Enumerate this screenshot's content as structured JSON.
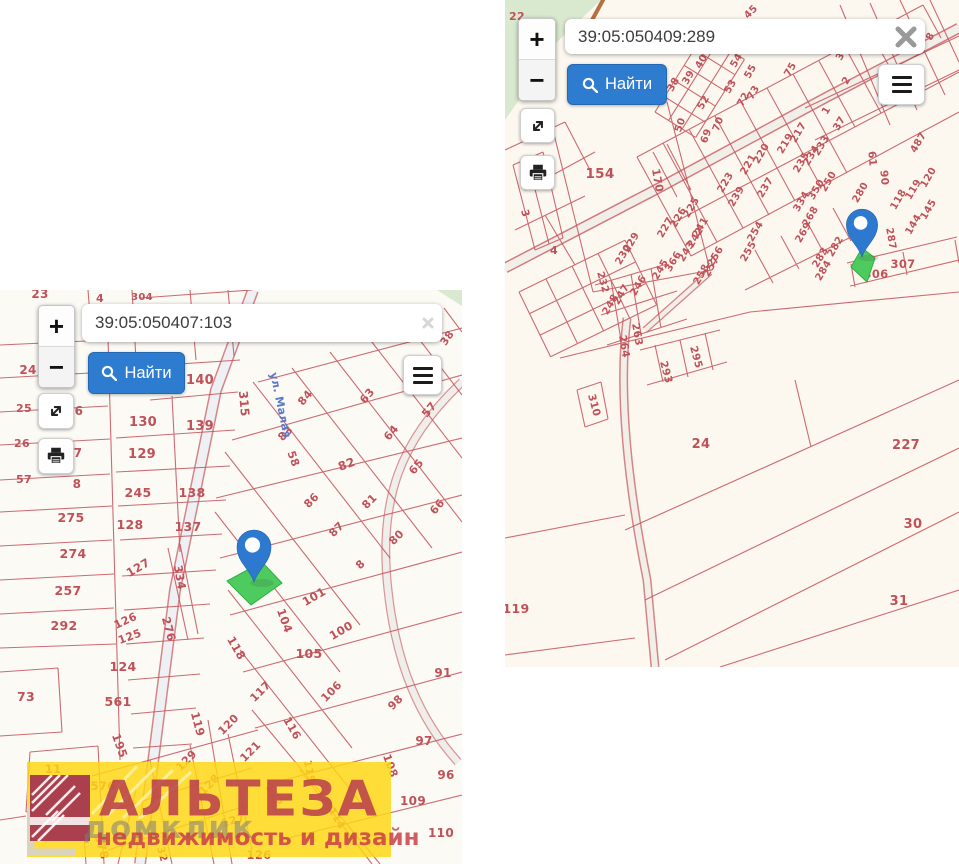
{
  "ui": {
    "zoom_in": "+",
    "zoom_out": "−",
    "find_label": "Найти"
  },
  "colors": {
    "parcel_line": "#c4525a",
    "parcel_label": "#bf5259",
    "marker_blue": "#2e79d0",
    "highlight_green": "#4ecb5f",
    "watermark_yellow": "#ffd614",
    "road_label_blue": "#5b79c4",
    "find_button_blue": "#2e7cd0",
    "vegetation_green": "#d9e9cf"
  },
  "watermark": {
    "brand": "АЛЬТЕЗА",
    "overlay": "домклик",
    "tagline": "недвижимость и дизайн"
  },
  "panels": {
    "left": {
      "search_value": "39:05:050407:103",
      "labels": [
        [
          "23",
          40,
          8,
          0,
          12
        ],
        [
          "4",
          100,
          12,
          0,
          11
        ],
        [
          "304",
          142,
          10,
          0,
          10
        ],
        [
          "38",
          450,
          50,
          -55,
          10.5
        ],
        [
          "24",
          28,
          84,
          0,
          12
        ],
        [
          "140",
          200,
          94,
          0,
          13
        ],
        [
          "315",
          240,
          114,
          85,
          12
        ],
        [
          "130",
          143,
          136,
          0,
          13
        ],
        [
          "139",
          200,
          140,
          0,
          13
        ],
        [
          "84",
          308,
          110,
          -50,
          11
        ],
        [
          "63",
          370,
          108,
          -50,
          11
        ],
        [
          "57",
          432,
          122,
          -50,
          11
        ],
        [
          "129",
          142,
          168,
          0,
          13
        ],
        [
          "83",
          288,
          146,
          -45,
          11
        ],
        [
          "64",
          394,
          145,
          -50,
          11
        ],
        [
          "58",
          290,
          170,
          70,
          11
        ],
        [
          "82",
          348,
          178,
          -20,
          12
        ],
        [
          "65",
          419,
          179,
          -50,
          11
        ],
        [
          "25",
          24,
          122,
          0,
          11
        ],
        [
          "6",
          79,
          125,
          0,
          12
        ],
        [
          "26",
          22,
          157,
          0,
          11
        ],
        [
          "7",
          78,
          167,
          0,
          12
        ],
        [
          "57",
          24,
          193,
          0,
          11
        ],
        [
          "8",
          77,
          198,
          0,
          12
        ],
        [
          "245",
          138,
          207,
          0,
          12.5
        ],
        [
          "138",
          192,
          207,
          0,
          12.5
        ],
        [
          "86",
          314,
          213,
          -45,
          11
        ],
        [
          "81",
          372,
          214,
          -45,
          11
        ],
        [
          "66",
          440,
          219,
          -50,
          11
        ],
        [
          "275",
          71,
          232,
          0,
          12.5
        ],
        [
          "128",
          130,
          239,
          0,
          12.5
        ],
        [
          "137",
          188,
          241,
          0,
          12.5
        ],
        [
          "87",
          339,
          242,
          -45,
          11
        ],
        [
          "80",
          399,
          250,
          -45,
          11
        ],
        [
          "274",
          73,
          268,
          0,
          12.5
        ],
        [
          "127",
          140,
          281,
          -30,
          11.5
        ],
        [
          "334",
          176,
          288,
          80,
          11.5
        ],
        [
          "8",
          363,
          277,
          -45,
          11
        ],
        [
          "257",
          68,
          305,
          0,
          12.5
        ],
        [
          "101",
          316,
          310,
          -30,
          11.5
        ],
        [
          "276",
          165,
          340,
          75,
          11.5
        ],
        [
          "292",
          64,
          340,
          0,
          12.5
        ],
        [
          "126",
          127,
          334,
          -25,
          11
        ],
        [
          "125",
          131,
          350,
          -20,
          11
        ],
        [
          "100",
          343,
          344,
          -30,
          11.5
        ],
        [
          "104",
          281,
          332,
          70,
          11.5
        ],
        [
          "124",
          123,
          381,
          0,
          12.5
        ],
        [
          "105",
          309,
          368,
          0,
          12.5
        ],
        [
          "118",
          233,
          360,
          60,
          11.5
        ],
        [
          "91",
          443,
          387,
          0,
          12
        ],
        [
          "73",
          26,
          411,
          0,
          12.5
        ],
        [
          "561",
          118,
          416,
          0,
          12.5
        ],
        [
          "106",
          334,
          404,
          -45,
          11
        ],
        [
          "117",
          263,
          404,
          -45,
          11
        ],
        [
          "98",
          398,
          415,
          -45,
          11
        ],
        [
          "119",
          194,
          435,
          75,
          11.5
        ],
        [
          "120",
          231,
          437,
          -45,
          11
        ],
        [
          "195",
          116,
          457,
          70,
          11.5
        ],
        [
          "116",
          289,
          440,
          60,
          11
        ],
        [
          "97",
          424,
          455,
          0,
          12
        ],
        [
          "121",
          253,
          464,
          -45,
          11
        ],
        [
          "129",
          189,
          473,
          -45,
          11
        ],
        [
          "108",
          387,
          477,
          70,
          11
        ],
        [
          "115",
          306,
          482,
          80,
          10.5
        ],
        [
          "96",
          446,
          489,
          0,
          12
        ],
        [
          "11",
          53,
          483,
          0,
          11.5
        ],
        [
          "128",
          212,
          497,
          -45,
          11
        ],
        [
          "122",
          271,
          507,
          60,
          11
        ],
        [
          "576",
          103,
          500,
          0,
          11.5
        ],
        [
          "109",
          413,
          515,
          0,
          12
        ],
        [
          "114",
          334,
          530,
          60,
          10.5
        ],
        [
          "127",
          234,
          534,
          -15,
          11
        ],
        [
          "110",
          441,
          547,
          0,
          12
        ],
        [
          "267",
          47,
          550,
          0,
          11.5
        ],
        [
          "578",
          98,
          558,
          75,
          11.5
        ],
        [
          "126",
          259,
          569,
          0,
          11.5
        ],
        [
          "32",
          159,
          565,
          75,
          10.5
        ],
        [
          "ул. Малая",
          277,
          116,
          78,
          11,
          "#5b79c4"
        ]
      ]
    },
    "right": {
      "search_value": "39:05:050409:289",
      "labels": [
        [
          "22",
          12,
          20,
          0,
          11
        ],
        [
          "45",
          248,
          14,
          -45,
          10
        ],
        [
          "40",
          199,
          63,
          -60,
          10
        ],
        [
          "54",
          234,
          62,
          -60,
          10
        ],
        [
          "39",
          186,
          79,
          -60,
          10
        ],
        [
          "55",
          248,
          73,
          -60,
          10
        ],
        [
          "75",
          288,
          71,
          -60,
          10
        ],
        [
          "38",
          171,
          86,
          -60,
          10
        ],
        [
          "53",
          228,
          88,
          -60,
          10
        ],
        [
          "73",
          251,
          94,
          -60,
          10
        ],
        [
          "52",
          201,
          104,
          -60,
          10
        ],
        [
          "72",
          241,
          101,
          -60,
          10
        ],
        [
          "8",
          428,
          38,
          -60,
          10
        ],
        [
          "2",
          344,
          82,
          -60,
          10
        ],
        [
          "3",
          338,
          58,
          -60,
          10
        ],
        [
          "1",
          324,
          112,
          -60,
          10
        ],
        [
          "37",
          337,
          125,
          -60,
          10
        ],
        [
          "50",
          178,
          126,
          -70,
          10
        ],
        [
          "70",
          216,
          125,
          -70,
          10
        ],
        [
          "69",
          204,
          137,
          -70,
          10
        ],
        [
          "154",
          95,
          178,
          0,
          13.5
        ],
        [
          "170",
          149,
          181,
          80,
          11
        ],
        [
          "61",
          364,
          159,
          85,
          10.5
        ],
        [
          "487",
          416,
          144,
          -60,
          10
        ],
        [
          "221",
          246,
          166,
          -60,
          10
        ],
        [
          "220",
          259,
          155,
          -60,
          10
        ],
        [
          "219",
          283,
          145,
          -60,
          10
        ],
        [
          "217",
          296,
          134,
          -60,
          10
        ],
        [
          "90",
          376,
          178,
          85,
          10.5
        ],
        [
          "120",
          426,
          179,
          -60,
          10
        ],
        [
          "119",
          411,
          191,
          -60,
          10
        ],
        [
          "118",
          396,
          201,
          -60,
          10
        ],
        [
          "145",
          426,
          211,
          -60,
          10
        ],
        [
          "144",
          411,
          226,
          -60,
          10
        ],
        [
          "223",
          223,
          184,
          -60,
          10
        ],
        [
          "239",
          234,
          198,
          -60,
          10
        ],
        [
          "237",
          263,
          189,
          -60,
          10
        ],
        [
          "233",
          319,
          147,
          -60,
          10
        ],
        [
          "234",
          309,
          157,
          -60,
          10
        ],
        [
          "235",
          299,
          164,
          -60,
          10
        ],
        [
          "250",
          326,
          183,
          -60,
          10
        ],
        [
          "350",
          314,
          191,
          -60,
          10
        ],
        [
          "334",
          299,
          203,
          -60,
          10
        ],
        [
          "268",
          308,
          218,
          -60,
          10
        ],
        [
          "269",
          301,
          234,
          -60,
          10
        ],
        [
          "280",
          358,
          194,
          -60,
          10
        ],
        [
          "287",
          383,
          239,
          80,
          10
        ],
        [
          "282",
          333,
          248,
          -60,
          10
        ],
        [
          "283",
          318,
          259,
          -60,
          10
        ],
        [
          "284",
          321,
          272,
          -60,
          10
        ],
        [
          "225",
          189,
          209,
          -60,
          10
        ],
        [
          "226",
          176,
          219,
          -60,
          10
        ],
        [
          "227",
          163,
          229,
          -60,
          10
        ],
        [
          "229",
          129,
          244,
          -60,
          10
        ],
        [
          "230",
          121,
          256,
          -60,
          10
        ],
        [
          "241",
          198,
          229,
          -60,
          10
        ],
        [
          "242",
          193,
          239,
          -60,
          10
        ],
        [
          "243",
          184,
          253,
          -60,
          10
        ],
        [
          "366",
          171,
          263,
          -60,
          10
        ],
        [
          "245",
          158,
          271,
          -60,
          10
        ],
        [
          "254",
          253,
          233,
          -60,
          10
        ],
        [
          "255",
          246,
          253,
          -60,
          10
        ],
        [
          "256",
          213,
          258,
          -60,
          10
        ],
        [
          "257",
          209,
          268,
          -60,
          10
        ],
        [
          "258",
          199,
          276,
          -60,
          10
        ],
        [
          "232",
          95,
          283,
          75,
          10
        ],
        [
          "248",
          108,
          306,
          -60,
          10
        ],
        [
          "247",
          119,
          296,
          -60,
          10
        ],
        [
          "246",
          136,
          287,
          -60,
          10
        ],
        [
          "263",
          129,
          335,
          80,
          10.5
        ],
        [
          "264",
          116,
          347,
          80,
          10.5
        ],
        [
          "295",
          188,
          358,
          75,
          10.5
        ],
        [
          "293",
          158,
          373,
          75,
          10.5
        ],
        [
          "310",
          86,
          406,
          75,
          10.5
        ],
        [
          "306",
          371,
          278,
          0,
          11.5
        ],
        [
          "307",
          398,
          268,
          0,
          11.5
        ],
        [
          "3",
          17,
          214,
          75,
          10.5
        ],
        [
          "4",
          49,
          254,
          0,
          11
        ],
        [
          "24",
          196,
          448,
          0,
          13
        ],
        [
          "227",
          401,
          449,
          0,
          13
        ],
        [
          "30",
          408,
          528,
          0,
          13
        ],
        [
          "31",
          394,
          605,
          0,
          13
        ],
        [
          "119",
          11,
          613,
          0,
          12.5
        ]
      ]
    }
  }
}
